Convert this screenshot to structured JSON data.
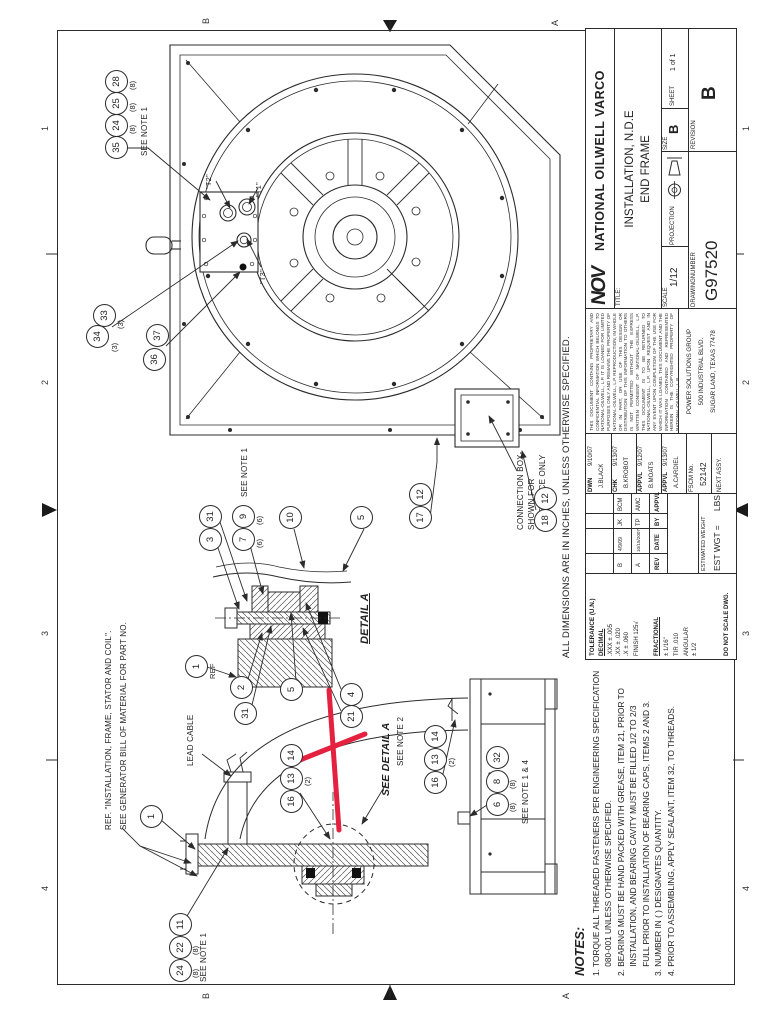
{
  "colors": {
    "line": "#2b2b2b",
    "red": "#e4213f"
  },
  "zones": {
    "top": [
      "4",
      "3",
      "2",
      "1"
    ],
    "bottom": [
      "4",
      "3",
      "2",
      "1"
    ],
    "left": [
      "B",
      "A"
    ],
    "right": [
      "B",
      "A"
    ]
  },
  "dims_note": "ALL DIMENSIONS ARE IN INCHES, UNLESS OTHERWISE SPECIFIED.",
  "notes": {
    "heading": "NOTES:",
    "lines": [
      "1. TORQUE ALL THREADED FASTENERS PER ENGINEERING SPECIFICATION",
      "    080-001 UNLESS OTHERWISE SPECIFIED.",
      "2. BEARING MUST BE HAND PACKED WITH GREASE, ITEM 21, PRIOR TO",
      "    INSTALLATION, AND BEARING CAVITY MUST BE FILLED 1/2 TO 2/3",
      "    FULL PRIOR TO INSTALLATION OF BEARING CAPS, ITEMS 2 AND 3.",
      "3. NUMBER IN ( ) DESIGNATES QUANTITY.",
      "4. PRIOR TO ASSEMBLING, APPLY SEALANT, ITEM 32, TO THREADS."
    ]
  },
  "callouts": {
    "ref_line1": "REF. \"INSTALLATION, FRAME, STATOR AND COIL\".",
    "ref_line2": "SEE GENERATOR BILL OF MATERIAL FOR PART NO.",
    "lead_cable": "LEAD CABLE",
    "connection_box": [
      "CONNECTION BOX-",
      "SHOWN FOR",
      "REFERENCE ONLY"
    ],
    "see_detail_a": "SEE DETAIL A",
    "see_note_1": "SEE NOTE 1",
    "see_note_2": "SEE NOTE 2",
    "see_note_1_4": "SEE NOTE 1 & 4",
    "detail_a": "DETAIL A",
    "ref": "REF",
    "t1": "\"T1\"",
    "t2": "\"T2\"",
    "t3": "\"T3\""
  },
  "balloons": {
    "n1": "1",
    "n2": "2",
    "n3": "3",
    "n4": "4",
    "n5": "5",
    "n6": "6",
    "n7": "7",
    "n8": "8",
    "n9": "9",
    "n10": "10",
    "n11": "11",
    "n12": "12",
    "n13": "13",
    "n14": "14",
    "n16": "16",
    "n17": "17",
    "n18": "18",
    "n21": "21",
    "n22": "22",
    "n24": "24",
    "n25": "25",
    "n28": "28",
    "n31": "31",
    "n32": "32",
    "n33": "33",
    "n34": "34",
    "n35": "35",
    "n36": "36",
    "n37": "37"
  },
  "qty": {
    "q2": "(2)",
    "q3": "(3)",
    "q6": "(6)",
    "q8": "(8)"
  },
  "title_block": {
    "brand": {
      "logo": "NOV",
      "name": "NATIONAL OILWELL VARCO"
    },
    "legal": "THIS DOCUMENT CONTAINS PROPRIETARY AND CONFIDENTIAL INFORMATION WHICH BELONGS TO NATIONAL-OILWELL, L.P. IT IS LOANED FOR LIMITED PURPOSES ONLY AND REMAINS THE PROPERTY OF NATIONAL-OILWELL, L.P. REPRODUCTION, IN WHOLE OR IN PART, OR USE OF THIS DESIGN OR DISTRIBUTION OF THIS INFORMATION TO OTHERS IS NOT PERMITTED WITHOUT THE EXPRESS WRITTEN CONSENT OF NATIONAL-OILWELL, L.P. THIS DOCUMENT IS TO BE RETURNED TO NATIONAL-OILWELL, L.P. UPON REQUEST AND IN ANY EVENT UPON COMPLETION OF THE USE FOR WHICH IT WAS LOANED. THIS DOCUMENT AND THE INFORMATION CONTAINED AND REPRESENTED HEREIN IS THE COPYRIGHTED PROPERTY OF NATIONAL-OILWELL, L.P.",
    "address": [
      "POWER SOLUTIONS GROUP",
      "500 INDUSTRIAL BLVD.",
      "SUGAR LAND, TEXAS 77478"
    ],
    "title_label": "TITLE:",
    "title1": "INSTALLATION, N.D.E",
    "title2": "END FRAME",
    "scale_label": "SCALE",
    "scale": "1/12",
    "dwg_label": "DRAWINGNUMBER",
    "dwg_number": "G97520",
    "projection_label": "PROJECTION",
    "size_label": "SIZE",
    "size": "B",
    "sheet_label": "SHEET",
    "sheet": "1 of 1",
    "rev_label": "REVISION",
    "revision": "B",
    "approvals": [
      {
        "role": "DWN",
        "date": "9/10/07",
        "name": "J.BLACK"
      },
      {
        "role": "CHK",
        "date": "9/13/07",
        "name": "B.KROBOT"
      },
      {
        "role": "APPVL",
        "date": "9/12/07",
        "name": "B.MOATS"
      },
      {
        "role": "APPVL",
        "date": "9/13/07",
        "name": "A.CARDIEL"
      }
    ],
    "fscm_label": "FSCM No.",
    "fscm": "52142",
    "next_assy": "NEXT ASSY.",
    "rev_table": {
      "headers": [
        "REV",
        "DATE",
        "BY",
        "APPVL"
      ],
      "rows": [
        [
          "B",
          "4/9/09",
          "JK",
          "BCM"
        ],
        [
          "A",
          "10/15/2007",
          "TP",
          "AMC"
        ]
      ]
    },
    "est_label": "ESTIMATED WEIGHT",
    "est_value": "EST WGT =      LBS",
    "tolerance": {
      "header": "TOLERANCE (U.N.)",
      "decimal": "DECIMAL",
      "d1": ".XXX ± .005",
      "d2": ".XX  ± .020",
      "d3": ".X    ± .060",
      "finish": "FINISH  125√",
      "fractional": "FRACTIONAL",
      "f1": "± 1/16\"",
      "f2": "TIR .010",
      "f3": "ANGULAR",
      "f4": "± 1/2",
      "noscale": "DO NOT SCALE DWG."
    }
  }
}
